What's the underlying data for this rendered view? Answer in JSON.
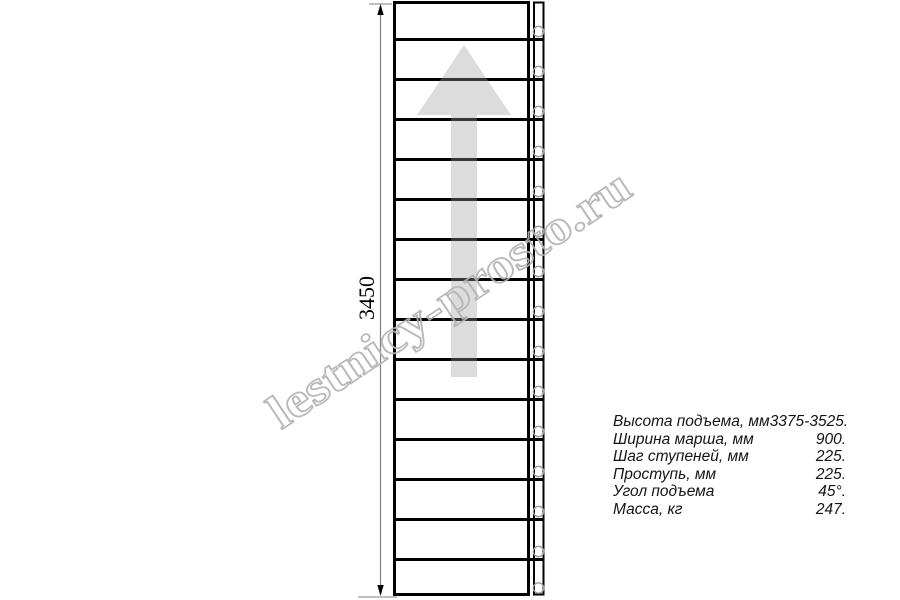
{
  "watermark": {
    "text": "lestnicy-prosto.ru"
  },
  "dimension": {
    "label": "3450"
  },
  "staircase": {
    "steps_count": 15
  },
  "specs": {
    "rows": [
      {
        "label": "Высота подъема, мм",
        "value": "3375-3525."
      },
      {
        "label": "Ширина марша, мм",
        "value": "900."
      },
      {
        "label": "Шаг ступеней, мм",
        "value": "225."
      },
      {
        "label": "Проступь, мм",
        "value": "225."
      },
      {
        "label": "Угол подъема",
        "value": "45°."
      },
      {
        "label": "Масса, кг",
        "value": "247."
      }
    ]
  },
  "colors": {
    "line": "#000000",
    "arrow_fill": "#9b9b9b",
    "dimension_line": "#7f7f7f",
    "circle_stroke": "#9c9c9c",
    "watermark_stroke": "#b2b2b2"
  }
}
